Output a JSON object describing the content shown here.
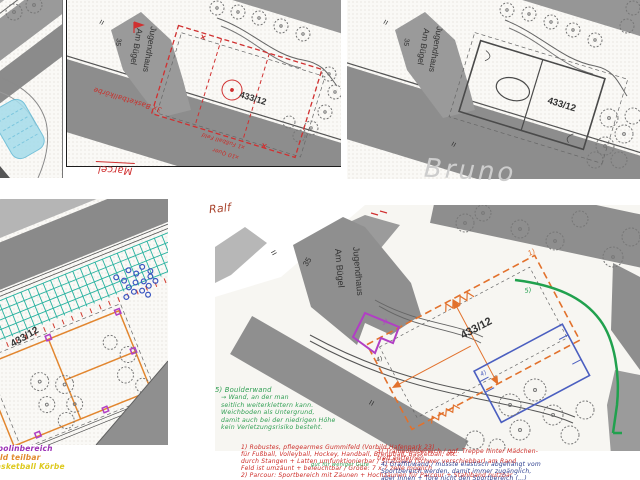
{
  "map_symbols": {
    "equals": "=",
    "parcel": "433/12"
  },
  "building": {
    "name_line1": "Jugendhaus",
    "name_line2": "Am Bügel",
    "house_number": "35"
  },
  "signatures": {
    "top_middle": "Marcel",
    "top_right": "Bruno",
    "bottom_right": "Ralf"
  },
  "pen_colors": {
    "red_pen": "#cc2b26",
    "green_pen": "#2f9e52",
    "blue_pen": "#2c3e8f",
    "orange_pen": "#e2712c",
    "purple_pen": "#b13fc4",
    "teal_pen": "#28b2a0",
    "yellow_pen": "#ddc91d",
    "pencil_gray": "#cdcdcd"
  },
  "top_middle_annotations": {
    "basketball": "3x Basketballkörbe",
    "football_line1": "x1 Fußball Feld",
    "football_line2": "x10 Quer"
  },
  "bottom_left_notes": [
    {
      "text": "Trampolinbereich",
      "color": "#9b30b5"
    },
    {
      "text": "Feld teilbar",
      "color": "#e08a2d"
    },
    {
      "text": "Basketball Körbe",
      "color": "#ddc91d"
    }
  ],
  "bottom_right": {
    "zone_labels": {
      "gummifeld": "1)",
      "trampolin": "3)",
      "graffitiwand": "4)",
      "boulderwand": "5)",
      "path_marker": "4)"
    },
    "notes": {
      "boulderwand": {
        "lines": [
          "5) Boulderwand",
          "→ Wand, an der man",
          "seitlich weiterklettern kann.",
          "Weichboden als Untergrund,",
          "damit auch bei der niedrigen Höhe",
          "kein Verletzungsrisiko besteht."
        ]
      },
      "gummifeld": {
        "lines": [
          "1) Robustes, pflegearmes Gummifeld (Vorbild Hafenpark 23)",
          "für Fußball, Volleyball, Hockey, Handball, Brennball, Basketball, etc.",
          "durch Stangen + Latten umfunktionierbar / Sitzbänke (schwer verschiebbar) am Rand",
          "Feld ist umzäunt + beleuchtbar / Größe: 7 x 7 zelle möglich",
          "2) Parcour: Sportbereich mit Zäunen + Hochzäunen für Parcour + Stahlband nutzbar"
        ],
        "inline_green": "gut für weniger Gute"
      },
      "trampolin": {
        "lines": [
          "3) Trampolinbereich / ggf. Treppe hinter Mädchen-",
          "treff entfernen"
        ]
      },
      "graffitiwand": {
        "lines": [
          "4) Graffitiwand / müsste elastisch abgehängt vom",
          "Sportbereich werden, damit immer zugänglich,",
          "aber Innen + Tore nicht den Sportbereich (…)"
        ]
      }
    }
  }
}
